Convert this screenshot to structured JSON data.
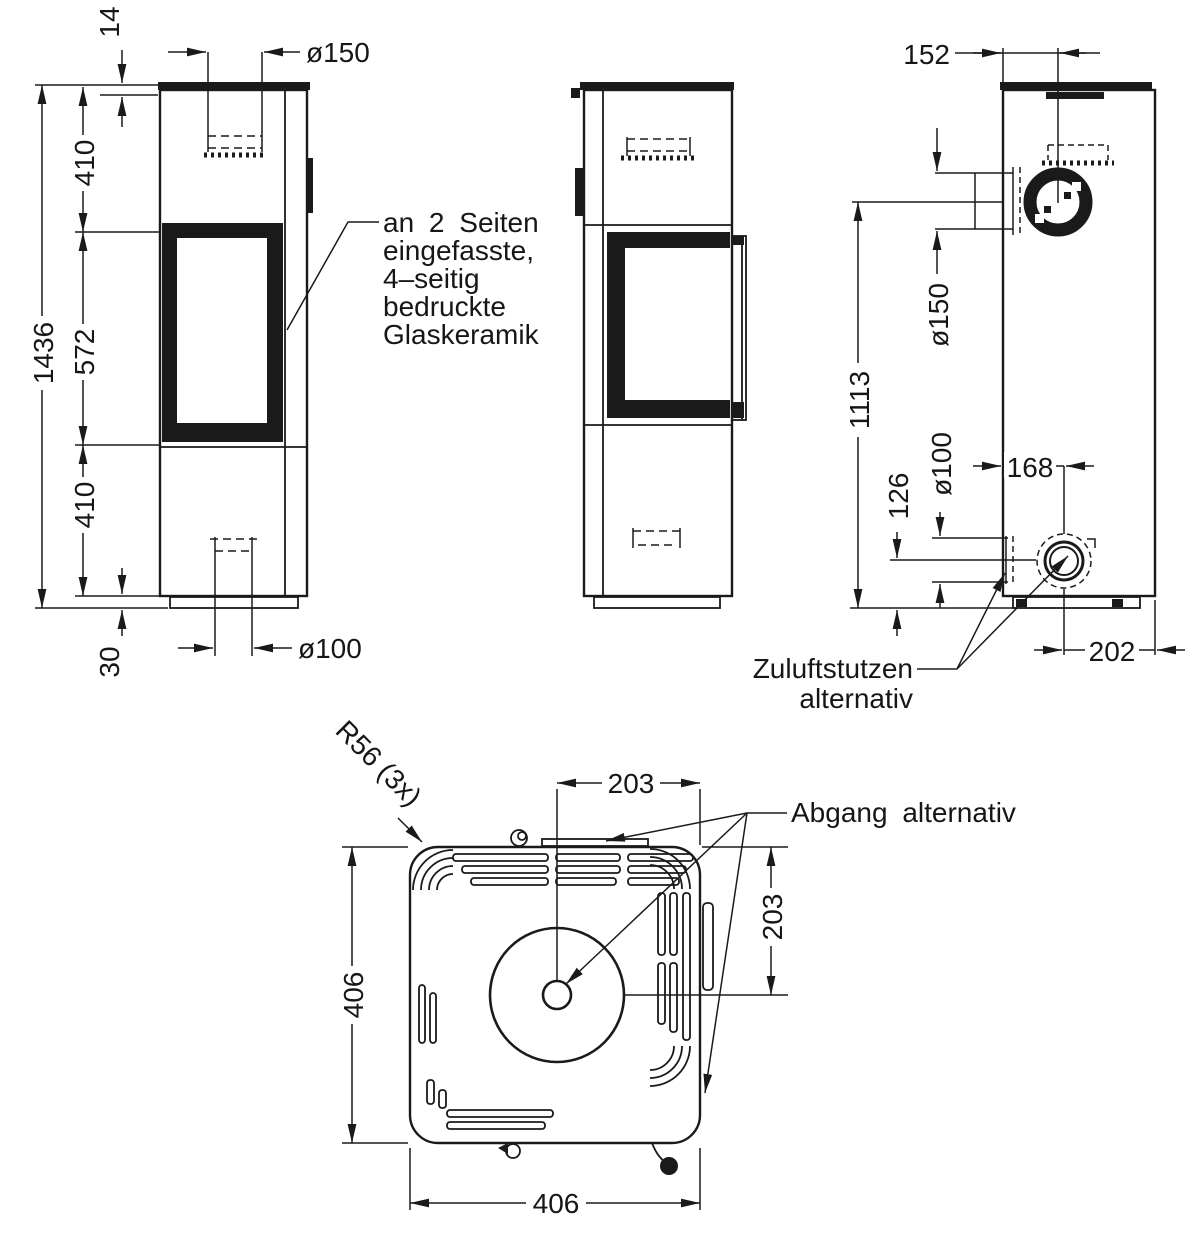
{
  "front_view": {
    "dim_top_plate": "14",
    "dim_upper_section": "410",
    "dim_glass_section": "572",
    "dim_lower_section": "410",
    "dim_total_height": "1436",
    "dim_plinth_height": "30",
    "dim_flue_diameter": "ø150",
    "dim_air_diameter": "ø100",
    "glass_note_line1": "an 2 Seiten",
    "glass_note_line2": "eingefasste,",
    "glass_note_line3": "4–seitig",
    "glass_note_line4": "bedruckte",
    "glass_note_line5": "Glaskeramik"
  },
  "rear_view": {
    "dim_flue_offset": "152",
    "dim_side_flue_diameter": "ø150",
    "dim_side_flue_height": "1113",
    "dim_air_socket_height": "126",
    "dim_air_socket_diameter": "ø100",
    "dim_air_socket_offset": "168",
    "dim_air_socket_offset_right": "202",
    "air_note_line1": "Zuluftstutzen",
    "air_note_line2": "alternativ"
  },
  "top_view": {
    "dim_corner_radius": "R56 (3x)",
    "dim_half_width_top": "203",
    "dim_depth": "406",
    "dim_half_depth_right": "203",
    "dim_width_bottom": "406",
    "outlet_note": "Abgang alternativ"
  }
}
